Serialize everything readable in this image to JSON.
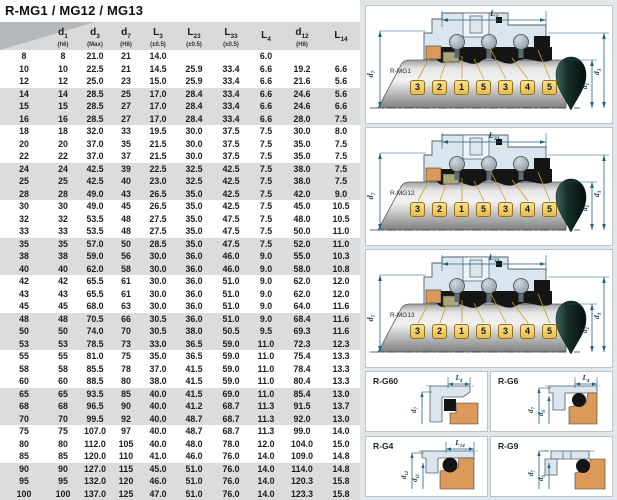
{
  "title": "R-MG1 / MG12 / MG13",
  "table": {
    "columns": [
      {
        "base": "",
        "sub": "",
        "tol": ""
      },
      {
        "base": "d",
        "sub": "1",
        "tol": "(h6)"
      },
      {
        "base": "d",
        "sub": "3",
        "tol": "(Max)"
      },
      {
        "base": "d",
        "sub": "7",
        "tol": "(H8)"
      },
      {
        "base": "L",
        "sub": "3",
        "tol": "(±0.5)"
      },
      {
        "base": "L",
        "sub": "23",
        "tol": "(±0.5)"
      },
      {
        "base": "L",
        "sub": "33",
        "tol": "(±0.5)"
      },
      {
        "base": "L",
        "sub": "4",
        "tol": ""
      },
      {
        "base": "d",
        "sub": "12",
        "tol": "(H8)"
      },
      {
        "base": "L",
        "sub": "14",
        "tol": ""
      }
    ],
    "rows": [
      [
        "8",
        "8",
        "21.0",
        "21",
        "14.0",
        "",
        "",
        "6.0",
        "",
        ""
      ],
      [
        "10",
        "10",
        "22.5",
        "21",
        "14.5",
        "25.9",
        "33.4",
        "6.6",
        "19.2",
        "6.6"
      ],
      [
        "12",
        "12",
        "25.0",
        "23",
        "15.0",
        "25.9",
        "33.4",
        "6.6",
        "21.6",
        "5.6"
      ],
      [
        "14",
        "14",
        "28.5",
        "25",
        "17.0",
        "28.4",
        "33.4",
        "6.6",
        "24.6",
        "5.6"
      ],
      [
        "15",
        "15",
        "28.5",
        "27",
        "17.0",
        "28.4",
        "33.4",
        "6.6",
        "24.6",
        "6.6"
      ],
      [
        "16",
        "16",
        "28.5",
        "27",
        "17.0",
        "28.4",
        "33.4",
        "6.6",
        "28.0",
        "7.5"
      ],
      [
        "18",
        "18",
        "32.0",
        "33",
        "19.5",
        "30.0",
        "37.5",
        "7.5",
        "30.0",
        "8.0"
      ],
      [
        "20",
        "20",
        "37.0",
        "35",
        "21.5",
        "30.0",
        "37.5",
        "7.5",
        "35.0",
        "7.5"
      ],
      [
        "22",
        "22",
        "37.0",
        "37",
        "21.5",
        "30.0",
        "37.5",
        "7.5",
        "35.0",
        "7.5"
      ],
      [
        "24",
        "24",
        "42.5",
        "39",
        "22.5",
        "32.5",
        "42.5",
        "7.5",
        "38.0",
        "7.5"
      ],
      [
        "25",
        "25",
        "42.5",
        "40",
        "23.0",
        "32.5",
        "42.5",
        "7.5",
        "38.0",
        "7.5"
      ],
      [
        "28",
        "28",
        "49.0",
        "43",
        "26.5",
        "35.0",
        "42.5",
        "7.5",
        "42.0",
        "9.0"
      ],
      [
        "30",
        "30",
        "49.0",
        "45",
        "26.5",
        "35.0",
        "42.5",
        "7.5",
        "45.0",
        "10.5"
      ],
      [
        "32",
        "32",
        "53.5",
        "48",
        "27.5",
        "35.0",
        "47.5",
        "7.5",
        "48.0",
        "10.5"
      ],
      [
        "33",
        "33",
        "53.5",
        "48",
        "27.5",
        "35.0",
        "47.5",
        "7.5",
        "50.0",
        "11.0"
      ],
      [
        "35",
        "35",
        "57.0",
        "50",
        "28.5",
        "35.0",
        "47.5",
        "7.5",
        "52.0",
        "11.0"
      ],
      [
        "38",
        "38",
        "59.0",
        "56",
        "30.0",
        "36.0",
        "46.0",
        "9.0",
        "55.0",
        "10.3"
      ],
      [
        "40",
        "40",
        "62.0",
        "58",
        "30.0",
        "36.0",
        "46.0",
        "9.0",
        "58.0",
        "10.8"
      ],
      [
        "42",
        "42",
        "65.5",
        "61",
        "30.0",
        "36.0",
        "51.0",
        "9.0",
        "62.0",
        "12.0"
      ],
      [
        "43",
        "43",
        "65.5",
        "61",
        "30.0",
        "36.0",
        "51.0",
        "9.0",
        "62.0",
        "12.0"
      ],
      [
        "45",
        "45",
        "68.0",
        "63",
        "30.0",
        "36.0",
        "51.0",
        "9.0",
        "64.0",
        "11.6"
      ],
      [
        "48",
        "48",
        "70.5",
        "66",
        "30.5",
        "36.0",
        "51.0",
        "9.0",
        "68.4",
        "11.6"
      ],
      [
        "50",
        "50",
        "74.0",
        "70",
        "30.5",
        "38.0",
        "50.5",
        "9.5",
        "69.3",
        "11.6"
      ],
      [
        "53",
        "53",
        "78.5",
        "73",
        "33.0",
        "36.5",
        "59.0",
        "11.0",
        "72.3",
        "12.3"
      ],
      [
        "55",
        "55",
        "81.0",
        "75",
        "35.0",
        "36.5",
        "59.0",
        "11.0",
        "75.4",
        "13.3"
      ],
      [
        "58",
        "58",
        "85.5",
        "78",
        "37.0",
        "41.5",
        "59.0",
        "11.0",
        "78.4",
        "13.3"
      ],
      [
        "60",
        "60",
        "88.5",
        "80",
        "38.0",
        "41.5",
        "59.0",
        "11.0",
        "80.4",
        "13.3"
      ],
      [
        "65",
        "65",
        "93.5",
        "85",
        "40.0",
        "41.5",
        "69.0",
        "11.0",
        "85.4",
        "13.0"
      ],
      [
        "68",
        "68",
        "96.5",
        "90",
        "40.0",
        "41.2",
        "68.7",
        "11.3",
        "91.5",
        "13.7"
      ],
      [
        "70",
        "70",
        "99.5",
        "92",
        "40.0",
        "48.7",
        "68.7",
        "11.3",
        "92.0",
        "13.0"
      ],
      [
        "75",
        "75",
        "107.0",
        "97",
        "40.0",
        "48.7",
        "68.7",
        "11.3",
        "99.0",
        "14.0"
      ],
      [
        "80",
        "80",
        "112.0",
        "105",
        "40.0",
        "48.0",
        "78.0",
        "12.0",
        "104.0",
        "15.0"
      ],
      [
        "85",
        "85",
        "120.0",
        "110",
        "41.0",
        "46.0",
        "76.0",
        "14.0",
        "109.0",
        "14.8"
      ],
      [
        "90",
        "90",
        "127.0",
        "115",
        "45.0",
        "51.0",
        "76.0",
        "14.0",
        "114.0",
        "14.8"
      ],
      [
        "95",
        "95",
        "132.0",
        "120",
        "46.0",
        "51.0",
        "76.0",
        "14.0",
        "120.3",
        "15.8"
      ],
      [
        "100",
        "100",
        "137.0",
        "125",
        "47.0",
        "51.0",
        "76.0",
        "14.0",
        "123.3",
        "15.8"
      ]
    ]
  },
  "callouts": [
    "3",
    "2",
    "1",
    "5",
    "3",
    "4",
    "5"
  ],
  "diagrams": [
    {
      "name": "R-MG1",
      "dim_top": {
        "base": "L",
        "sub": "3"
      },
      "dim_left": {
        "base": "d",
        "sub": "7"
      },
      "dim_right1": {
        "base": "d",
        "sub": "1"
      },
      "dim_right2": {
        "base": "d",
        "sub": "3"
      }
    },
    {
      "name": "R-MG12",
      "dim_top": {
        "base": "L",
        "sub": "23"
      },
      "dim_left": {
        "base": "d",
        "sub": "7"
      },
      "dim_right1": {
        "base": "d",
        "sub": "1"
      },
      "dim_right2": {
        "base": "d",
        "sub": "3"
      }
    },
    {
      "name": "R-MG13",
      "dim_top": {
        "base": "L",
        "sub": "33"
      },
      "dim_left": {
        "base": "d",
        "sub": "7"
      },
      "dim_right1": {
        "base": "d",
        "sub": "1"
      },
      "dim_right2": {
        "base": "d",
        "sub": "3"
      }
    }
  ],
  "detail_panels": [
    {
      "name": "R-G60",
      "dim_top": {
        "base": "L",
        "sub": "4"
      },
      "dims_left": [
        {
          "base": "d",
          "sub": "7"
        }
      ]
    },
    {
      "name": "R-G6",
      "dim_top": {
        "base": "L",
        "sub": "4"
      },
      "dims_left": [
        {
          "base": "d",
          "sub": "7"
        },
        {
          "base": "d",
          "sub": "6"
        }
      ]
    },
    {
      "name": "R-G4",
      "dim_top": {
        "base": "L",
        "sub": "14"
      },
      "dims_left": [
        {
          "base": "d",
          "sub": "12"
        },
        {
          "base": "d",
          "sub": "11"
        }
      ]
    },
    {
      "name": "R-G9",
      "dim_top": null,
      "dims_left": [
        {
          "base": "d",
          "sub": "7"
        },
        {
          "base": "d",
          "sub": "6"
        }
      ]
    }
  ],
  "colors": {
    "band_gray": "#dcdcdc",
    "header_gray": "#d9d9d9",
    "wedge_gray": "#b5b9bb",
    "right_bg": "#e0e6ea",
    "panel_border": "#b9c3cb",
    "housing_blue": "#dbe5ed",
    "orange": "#db9a59",
    "olive": "#a8a77b",
    "chip_gold": "#e7bd4b",
    "chip_border": "#8f7120",
    "dim_teal": "#1e6080",
    "leader_yellow": "#c9a127",
    "seal_black": "#151515"
  }
}
